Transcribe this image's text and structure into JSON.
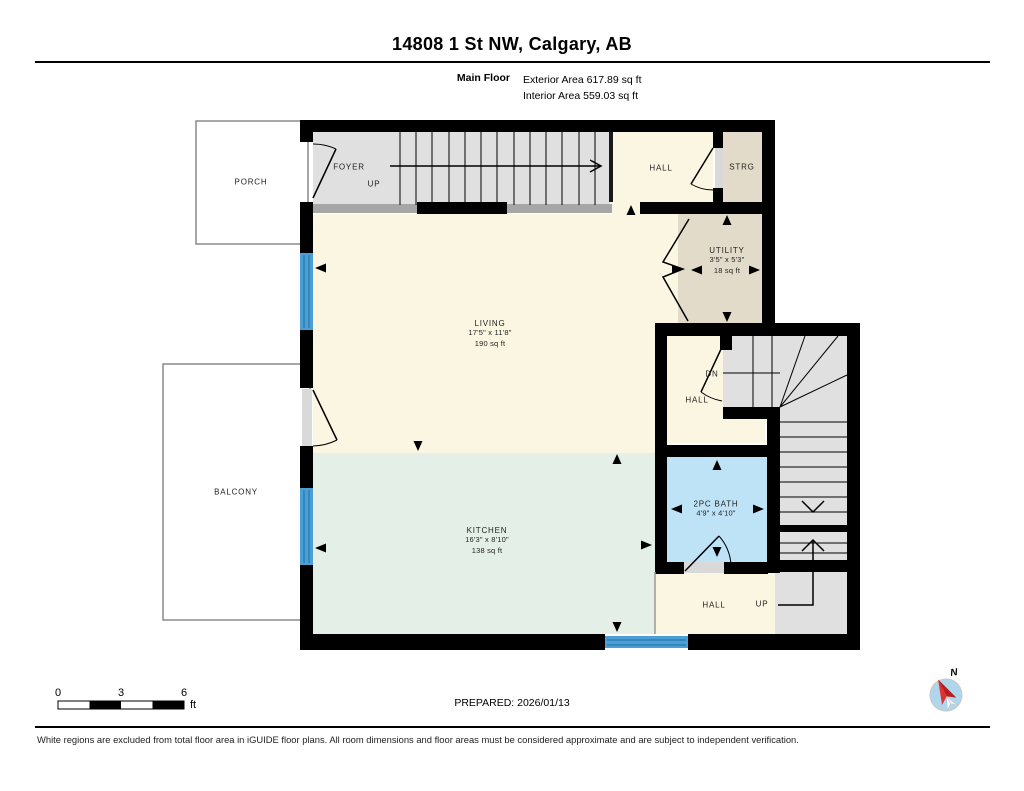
{
  "header": {
    "title": "14808 1 St NW, Calgary, AB",
    "floor_name": "Main Floor",
    "exterior_area": "Exterior Area 617.89 sq ft",
    "interior_area": "Interior Area 559.03 sq ft"
  },
  "rooms": {
    "porch": {
      "label": "PORCH"
    },
    "balcony": {
      "label": "BALCONY"
    },
    "foyer": {
      "label": "FOYER"
    },
    "stairs_top": {
      "up_label": "UP"
    },
    "hall_top": {
      "label": "HALL"
    },
    "strg": {
      "label": "STRG"
    },
    "utility": {
      "label": "UTILITY",
      "dims": "3'5\" x 5'3\"",
      "area": "18 sq ft"
    },
    "living": {
      "label": "LIVING",
      "dims": "17'5\" x 11'8\"",
      "area": "190 sq ft"
    },
    "hall_mid": {
      "dn_label": "DN",
      "label": "HALL"
    },
    "bath": {
      "label": "2PC BATH",
      "dims": "4'9\" x 4'10\""
    },
    "kitchen": {
      "label": "KITCHEN",
      "dims": "16'3\" x 8'10\"",
      "area": "138 sq ft"
    },
    "hall_bottom": {
      "label": "HALL"
    },
    "stairs_bottom": {
      "up_label": "UP"
    }
  },
  "scale_bar": {
    "ticks": [
      "0",
      "3",
      "6"
    ],
    "unit": "ft"
  },
  "compass": {
    "north_label": "N"
  },
  "footer": {
    "prepared": "PREPARED: 2026/01/13",
    "disclaimer": "White regions are excluded from total floor area in iGUIDE floor plans. All room dimensions and floor areas must be considered approximate and are subject to independent verification."
  },
  "colors": {
    "wall": "#000000",
    "floor_cream": "#FBF6E1",
    "floor_mint": "#E4EFE7",
    "floor_bath_blue": "#BEE3F6",
    "floor_tan": "#E3DBC9",
    "floor_stairs_gray": "#E0E0E0",
    "half_wall_gray": "#A6A6A6",
    "window_blue": "#4C9FD4",
    "compass_red": "#D62828",
    "compass_circle_blue": "#AFD6EA"
  }
}
